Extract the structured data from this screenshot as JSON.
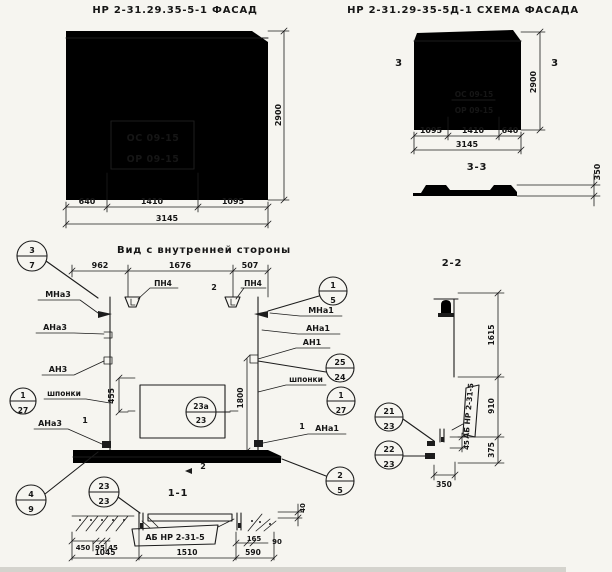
{
  "facade": {
    "title": "НР 2-31.29.35-5-1 ФАСАД",
    "window_line1": "ОС 09-15",
    "window_line2": "ОР 09-15",
    "dim_left": "640",
    "dim_mid": "1410",
    "dim_right": "1095",
    "dim_total": "3145",
    "dim_height": "2900"
  },
  "schema": {
    "title": "НР 2-31.29-35-5Д-1 СХЕМА ФАСАДА",
    "window_line1": "ОС 09-15",
    "window_line2": "ОР 09-15",
    "dim_left": "1095",
    "dim_mid": "1410",
    "dim_right": "640",
    "dim_total": "3145",
    "dim_height": "2900",
    "marker": "3",
    "section_title": "3-3",
    "section_thickness": "350"
  },
  "inner": {
    "title": "Вид с внутренней стороны",
    "dim_1": "962",
    "dim_2": "1676",
    "dim_3": "507",
    "pn4": "ПН4",
    "marker_2": "2",
    "marker_1": "1",
    "dim_455": "455",
    "dim_1800": "1800",
    "shponki": "шпонки",
    "mna3": "МНа3",
    "ana3": "АНа3",
    "an3": "АН3",
    "ana3_b": "АНа3",
    "mna1": "МНа1",
    "ana1": "АНа1",
    "an1": "АН1",
    "ana1_b": "АНа1",
    "c37": {
      "top": "3",
      "bot": "7"
    },
    "c127_l": {
      "top": "1",
      "bot": "27"
    },
    "c49": {
      "top": "4",
      "bot": "9"
    },
    "c15": {
      "top": "1",
      "bot": "5"
    },
    "c2524": {
      "top": "25",
      "bot": "24"
    },
    "c127_r": {
      "top": "1",
      "bot": "27"
    },
    "c25": {
      "top": "2",
      "bot": "5"
    },
    "c23a": {
      "top": "23а",
      "bot": "23"
    }
  },
  "s11": {
    "title": "1-1",
    "c2323": {
      "top": "23",
      "bot": "23"
    },
    "label": "АБ НР 2-31-5",
    "d450": "450",
    "d95": "95",
    "d45": "45",
    "d1045": "1045",
    "d1510": "1510",
    "d165": "165",
    "d90": "90",
    "d590": "590",
    "d40": "40"
  },
  "s22": {
    "title": "2-2",
    "label": "АБ НР 2-31-5",
    "d1615": "1615",
    "d910": "910",
    "d375": "375",
    "d350": "350",
    "d45": "45",
    "c2123": {
      "top": "21",
      "bot": "23"
    },
    "c2223": {
      "top": "22",
      "bot": "23"
    }
  }
}
